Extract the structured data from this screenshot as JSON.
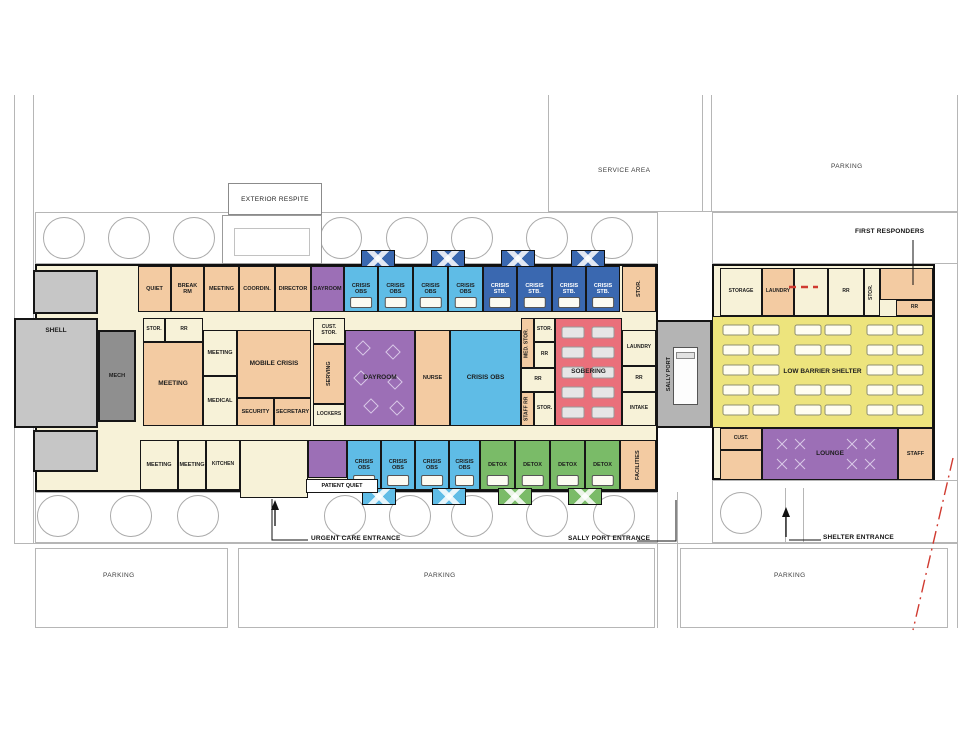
{
  "site": {
    "service_area": "SERVICE AREA",
    "parking_top": "PARKING",
    "parking_left": "PARKING",
    "parking_center": "PARKING",
    "parking_right": "PARKING",
    "exterior_respite": "EXTERIOR RESPITE"
  },
  "annotations": {
    "first_responders": "FIRST RESPONDERS",
    "urgent_care": "URGENT CARE ENTRANCE",
    "sally_port": "SALLY PORT ENTRANCE",
    "shelter": "SHELTER ENTRANCE"
  },
  "main": {
    "top": [
      "QUIET",
      "BREAK RM",
      "MEETING",
      "COORDIN.",
      "DIRECTOR",
      "DAYROOM",
      "CRISIS OBS",
      "CRISIS OBS",
      "CRISIS OBS",
      "CRISIS OBS",
      "CRISIS STB.",
      "CRISIS STB.",
      "CRISIS STB.",
      "CRISIS STB.",
      "STOR."
    ],
    "left": [
      "SHELL",
      "MECH"
    ],
    "mid": [
      "STOR.",
      "RR",
      "MEETING",
      "MEETING",
      "MEDICAL",
      "MOBILE CRISIS",
      "SECURITY",
      "SECRETARY",
      "CUST. STOR.",
      "SERVING",
      "LOCKERS",
      "DAYROOM",
      "NURSE",
      "CRISIS OBS",
      "MED. STOR.",
      "STOR.",
      "RR",
      "RR",
      "STAFF RR",
      "STOR.",
      "SOBERING",
      "LAUNDRY",
      "RR",
      "INTAKE"
    ],
    "bottom": [
      "MEETING",
      "MEETING",
      "KITCHEN",
      "PATIENT QUIET",
      "CRISIS OBS",
      "CRISIS OBS",
      "CRISIS OBS",
      "CRISIS OBS",
      "DETOX",
      "DETOX",
      "DETOX",
      "DETOX",
      "FACILITIES"
    ]
  },
  "sally_port_label": "SALLY PORT",
  "shelter": {
    "top": [
      "STORAGE",
      "LAUNDRY",
      "RR",
      "STOR.",
      "RR"
    ],
    "main_label": "LOW BARRIER SHELTER",
    "bottom": [
      "CUST.",
      "LOUNGE",
      "STAFF"
    ]
  },
  "colors": {
    "office_peach": "#F3CBA2",
    "corridor_cream": "#F7F2D8",
    "dayroom_purple": "#9C6FB6",
    "crisis_obs_blue": "#5FBCE6",
    "crisis_stb_blue": "#3A68B0",
    "sobering_red": "#EA707B",
    "detox_green": "#7ABB68",
    "shelter_yellow": "#EDE47D",
    "shell_gray": "#C6C6C6",
    "mech_gray": "#8F8F8F",
    "sally_port_gray": "#B4B4B4",
    "property_line_red": "#D03A30"
  }
}
